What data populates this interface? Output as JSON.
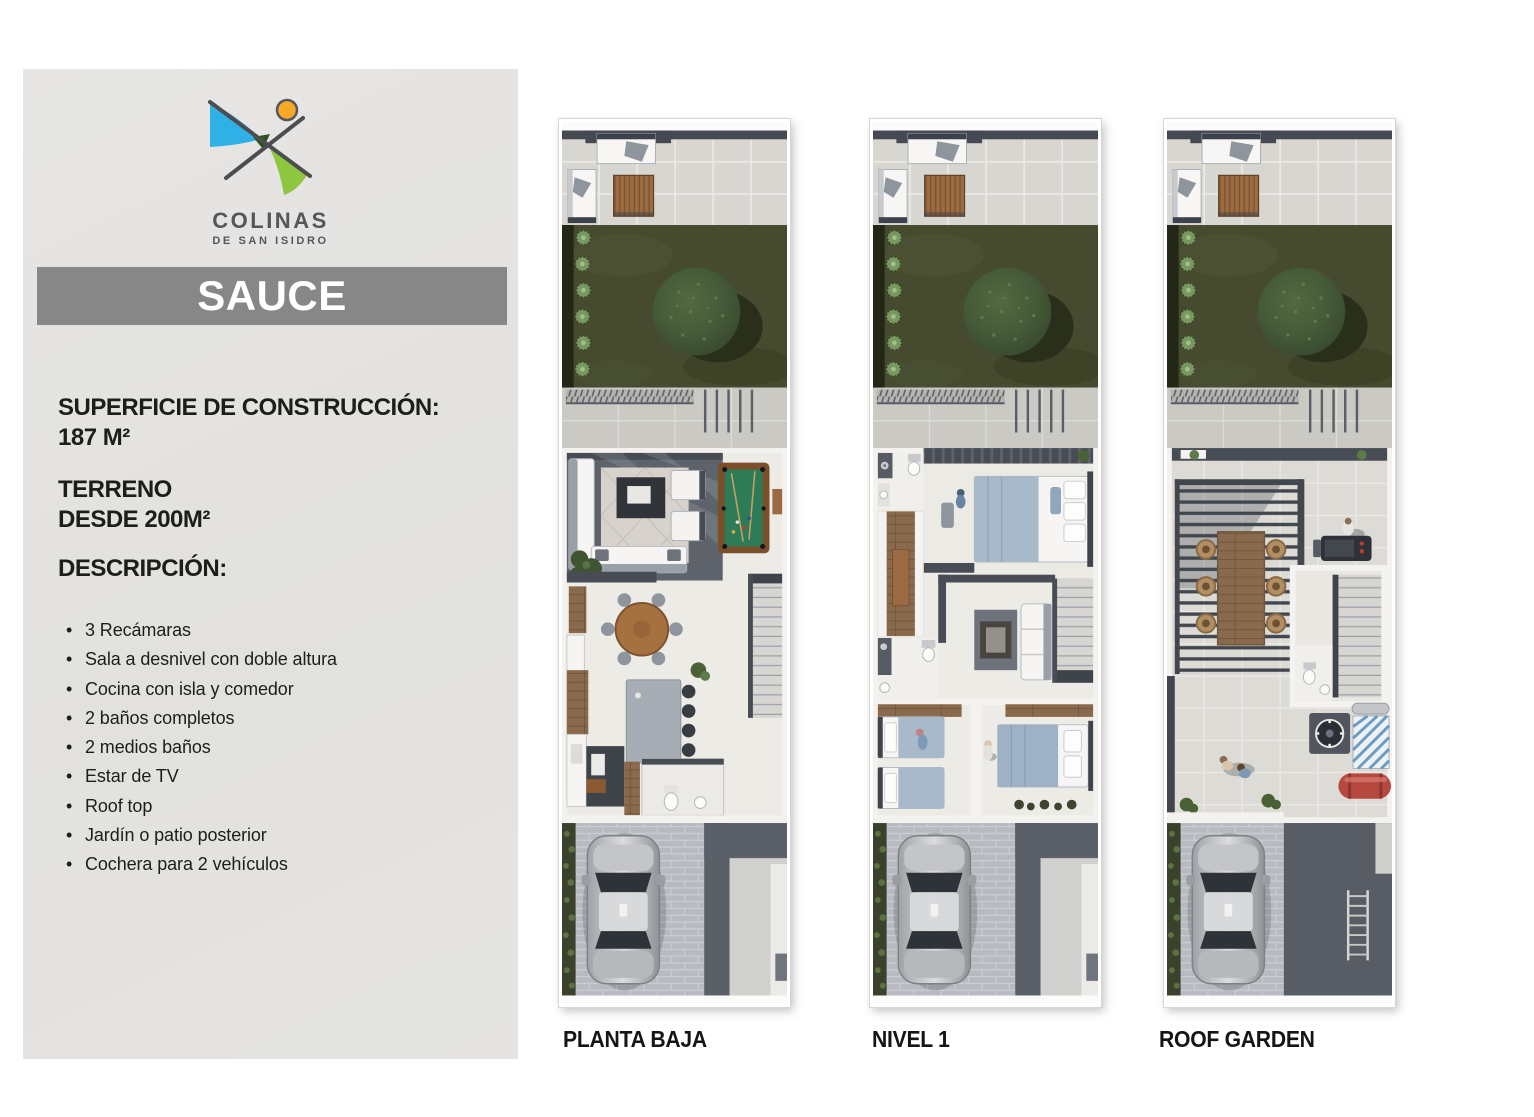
{
  "brand": {
    "name": "COLINAS",
    "tagline": "DE SAN ISIDRO"
  },
  "model": {
    "name": "SAUCE"
  },
  "specs": {
    "construction_label": "SUPERFICIE DE CONSTRUCCIÓN:",
    "construction_value": "187 M²",
    "land_label": "TERRENO",
    "land_value": "DESDE 200M²",
    "description_label": "DESCRIPCIÓN:"
  },
  "features": [
    "3 Recámaras",
    "Sala a desnivel con doble altura",
    "Cocina con isla y comedor",
    "2 baños completos",
    "2 medios baños",
    "Estar de TV",
    "Roof top",
    "Jardín o patio posterior",
    "Cochera para 2 vehículos"
  ],
  "plans": [
    {
      "label": "PLANTA BAJA"
    },
    {
      "label": "NIVEL 1"
    },
    {
      "label": "ROOF GARDEN"
    }
  ],
  "colors": {
    "logo_blue": "#2fb0e7",
    "logo_green": "#8dc63f",
    "logo_orange": "#f7a828",
    "banner_gray": "#878787",
    "panel_gray": "#e3e2e0",
    "text_dark": "#1d1d1b"
  }
}
